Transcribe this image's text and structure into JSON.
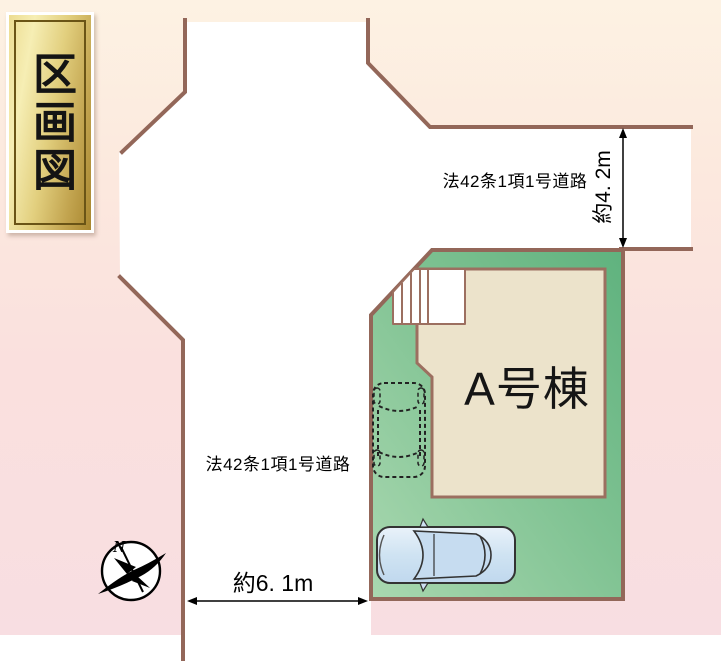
{
  "plaque": {
    "title": "区画図"
  },
  "plot": {
    "building_label": "A号棟",
    "road_label_top": "法42条1項1号道路",
    "road_label_left": "法42条1項1号道路",
    "dimension_top_road_width": "約4. 2m",
    "dimension_left_road_width": "約6. 1m"
  },
  "compass": {
    "north_label": "N"
  },
  "icons": {
    "compass": "north-arrow-bird-compass",
    "car_parked": "car-top-view",
    "car_parking_space": "car-dashed-outline",
    "stairs": "entrance-steps"
  },
  "colors": {
    "background_top": "#fdf1e2",
    "background_bottom": "#f8dee2",
    "road_surface": "#ffffff",
    "road_border": "#936759",
    "plot_green_dark": "#5fb27e",
    "plot_green_light": "#a9d8b0",
    "building_fill": "#ece3cb",
    "building_border": "#9c6f60",
    "plaque_gold": "#d9c26e",
    "car_blue": "#cfe3f2",
    "dimension_line": "#000000"
  }
}
